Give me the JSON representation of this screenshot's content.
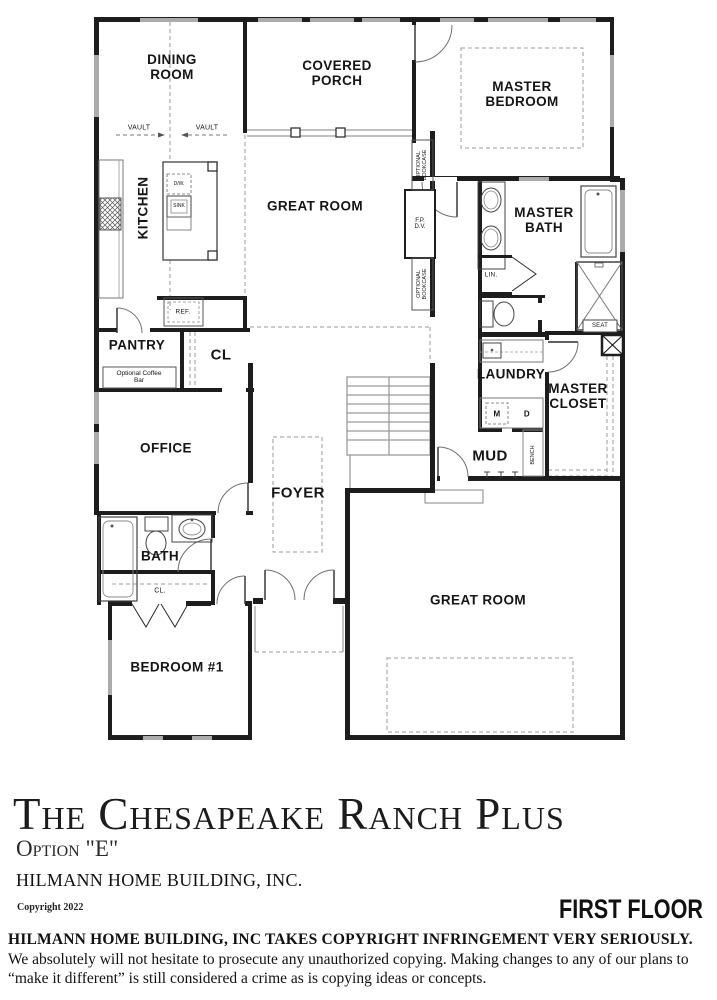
{
  "plan": {
    "rooms": {
      "dining": "DINING ROOM",
      "covered_porch": "COVERED PORCH",
      "master_bedroom": "MASTER BEDROOM",
      "kitchen": "KITCHEN",
      "great_room_upper": "GREAT ROOM",
      "master_bath": "MASTER BATH",
      "pantry": "PANTRY",
      "closet_hall": "CL",
      "laundry": "LAUNDRY",
      "master_closet": "MASTER CLOSET",
      "office": "OFFICE",
      "mud": "MUD",
      "foyer": "FOYER",
      "bath": "BATH",
      "bedroom1_closet": "CL.",
      "bedroom1": "BEDROOM #1",
      "great_room_lower": "GREAT ROOM"
    },
    "annotations": {
      "vault_left": "VAULT",
      "vault_right": "VAULT",
      "optional_bookcase_top": "OPTIONAL BOOKCASE",
      "optional_bookcase_bottom": "OPTIONAL BOOKCASE",
      "fireplace": "F.P. D.V.",
      "linen": "LIN.",
      "seat": "SEAT",
      "washer": "M",
      "dryer": "D",
      "bench": "BENCH",
      "refrigerator": "REF.",
      "dishwasher": "D/W.",
      "sink": "SINK",
      "coffee_bar": "Optional Coffee Bar"
    }
  },
  "title_block": {
    "plan_name": "The Chesapeake Ranch Plus",
    "option": "Option \"E\"",
    "builder": "HILMANN HOME BUILDING, INC.",
    "copyright": "Copyright 2022",
    "floor_label": "FIRST FLOOR"
  },
  "legal": {
    "bold": "HILMANN HOME BUILDING, INC TAKES COPYRIGHT INFRINGEMENT VERY SERIOUSLY.",
    "rest": "  We absolutely will not hesitate to prosecute any unauthorized copying.  Making changes to any of our plans to “make it different” is still considered a crime as is copying ideas or concepts."
  }
}
